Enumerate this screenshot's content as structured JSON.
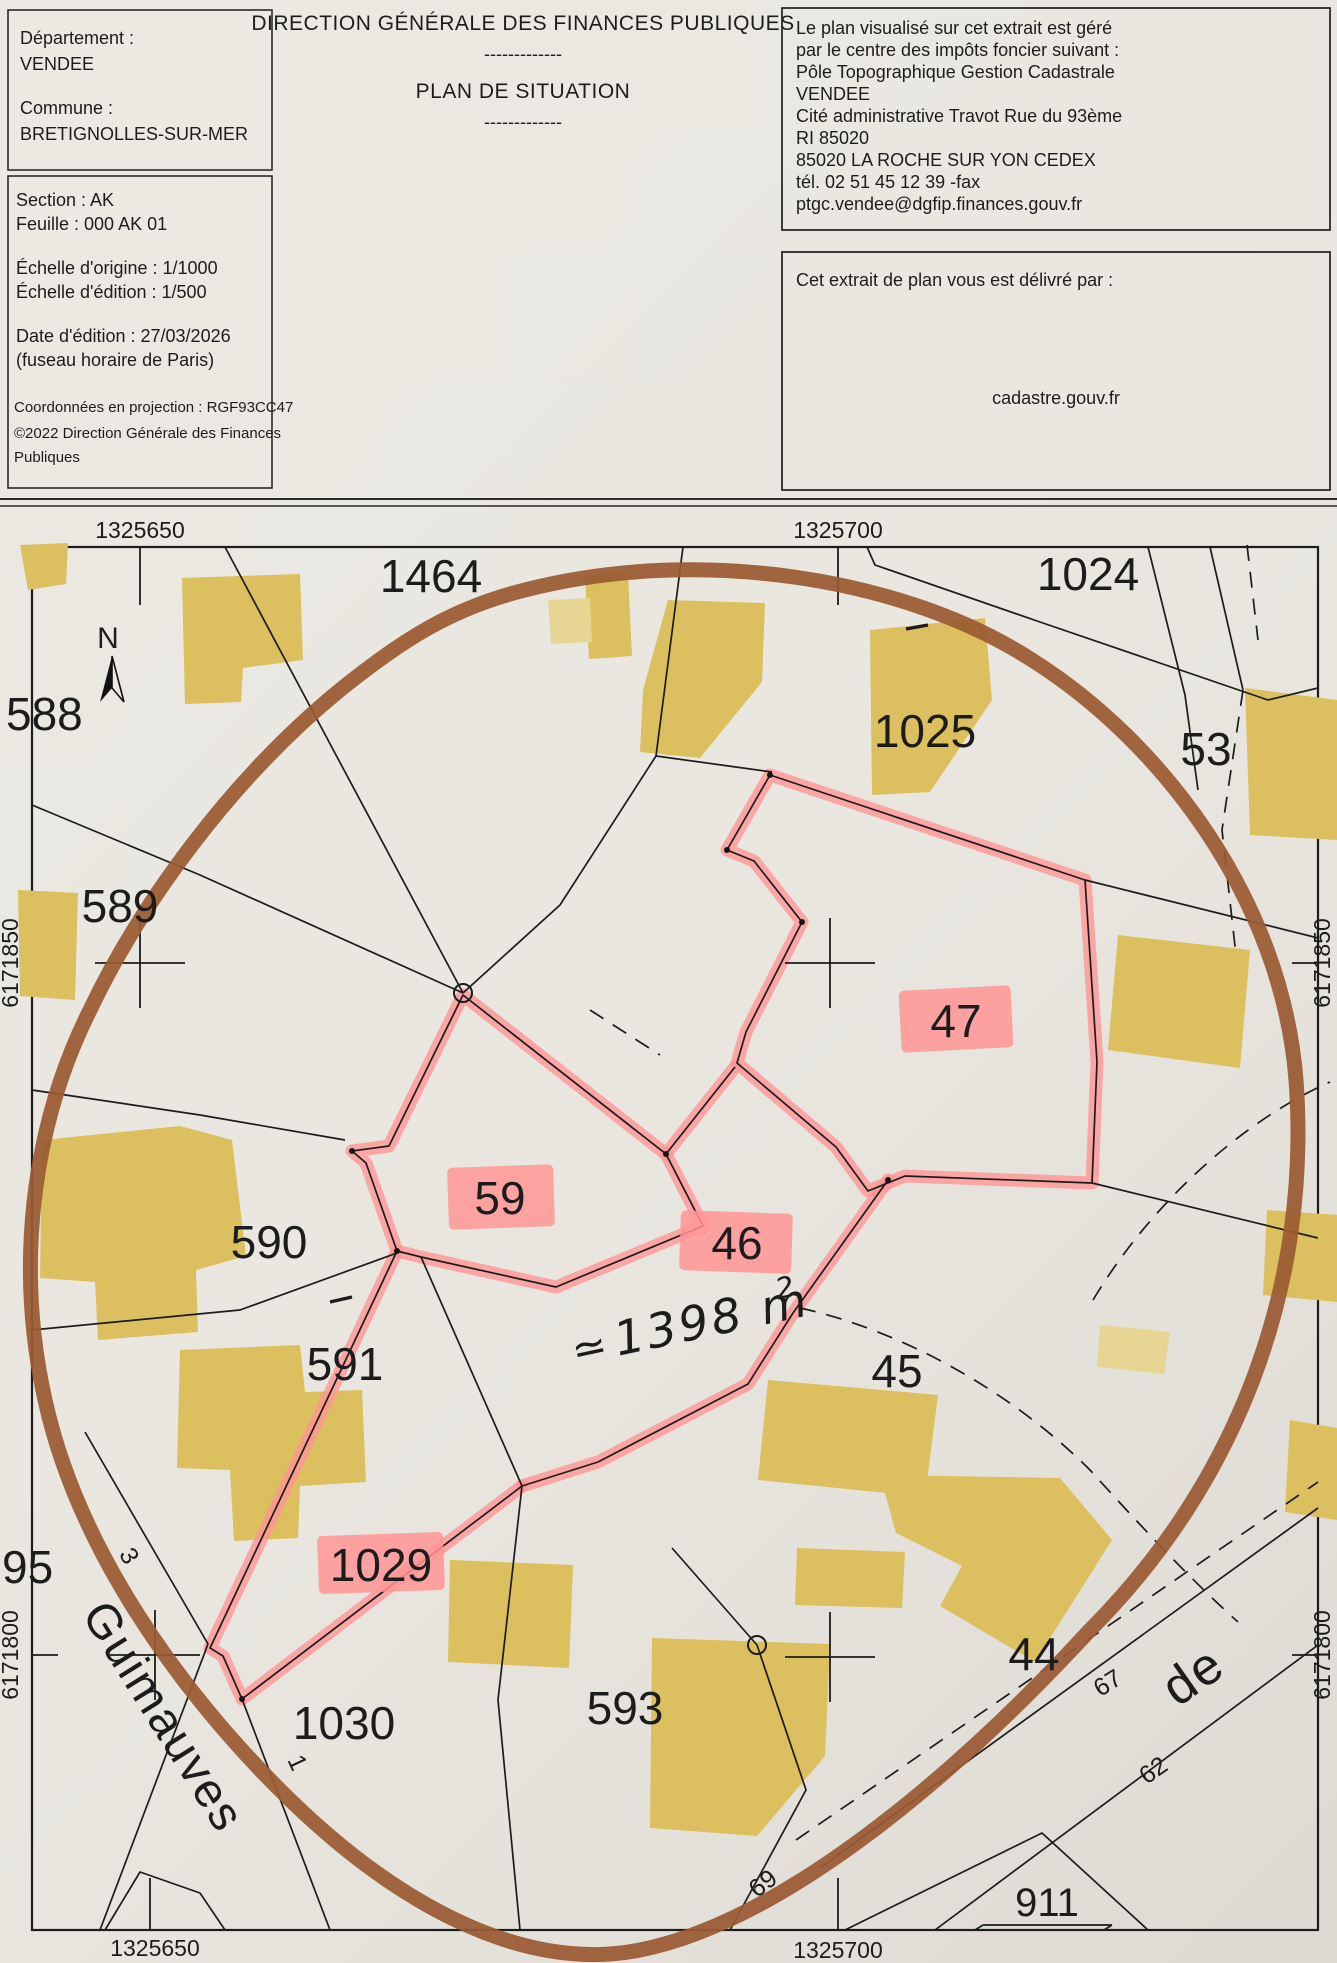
{
  "header": {
    "left_box": {
      "departement_label": "Département :",
      "departement": "VENDEE",
      "commune_label": "Commune :",
      "commune": "BRETIGNOLLES-SUR-MER"
    },
    "info_box": {
      "section": "Section : AK",
      "feuille": "Feuille : 000 AK 01",
      "echelle_origine": "Échelle d'origine : 1/1000",
      "echelle_edition": "Échelle d'édition : 1/500",
      "date_edition": "Date d'édition : 27/03/2026",
      "fuseau": "(fuseau horaire de Paris)",
      "projection": "Coordonnées en projection : RGF93CC47",
      "copyright_line1": "©2022 Direction Générale des Finances",
      "copyright_line2": "Publiques"
    },
    "title_line1": "DIRECTION GÉNÉRALE DES FINANCES PUBLIQUES",
    "separator1": "-------------",
    "title_line2": "PLAN DE SITUATION",
    "separator2": "-------------",
    "office_box": {
      "lines": [
        "Le plan visualisé sur cet extrait est géré",
        "par le centre des impôts foncier suivant :",
        "Pôle Topographique Gestion Cadastrale",
        "VENDEE",
        "Cité administrative Travot Rue du 93ème",
        "RI 85020",
        "85020 LA ROCHE SUR YON CEDEX",
        "tél. 02 51 45 12 39 -fax",
        "ptgc.vendee@dgfip.finances.gouv.fr"
      ]
    },
    "delivery_box": {
      "label": "Cet extrait de plan vous est délivré par :",
      "site": "cadastre.gouv.fr"
    }
  },
  "map": {
    "north_label": "N",
    "grid_labels": {
      "top_left": "1325650",
      "top_right": "1325700",
      "bottom_left": "1325650",
      "bottom_right": "1325700",
      "left_upper": "6171850",
      "left_lower": "6171800",
      "right_upper": "6171850",
      "right_lower": "6171800"
    },
    "parcels": {
      "p1464": "1464",
      "p1024": "1024",
      "p1025": "1025",
      "p53": "53",
      "p588": "588",
      "p589": "589",
      "p590": "590",
      "p591": "591",
      "p95": "95",
      "p1030": "1030",
      "p593": "593",
      "p45": "45",
      "p44": "44",
      "p911": "911",
      "p46": "46",
      "p47": "47",
      "p59": "59",
      "p1029": "1029"
    },
    "highlighted_parcels": [
      "46",
      "47",
      "59",
      "1029"
    ],
    "small_numbers": {
      "n3": "3",
      "n1": "1",
      "n67": "67",
      "n62": "62",
      "n69": "69"
    },
    "street_labels": {
      "guimauves": "Guimauves",
      "de": "de"
    },
    "annotation": {
      "approx": "≃",
      "value": "1398 m",
      "exponent": "2"
    },
    "colors": {
      "highlight_pink": "#ff9595",
      "building_yellow": "#dcbf5e",
      "building_light": "#e7d693",
      "circle_brown": "#9a5a33",
      "line_black": "#1c1c1c",
      "paper": "#eae7e1"
    }
  }
}
